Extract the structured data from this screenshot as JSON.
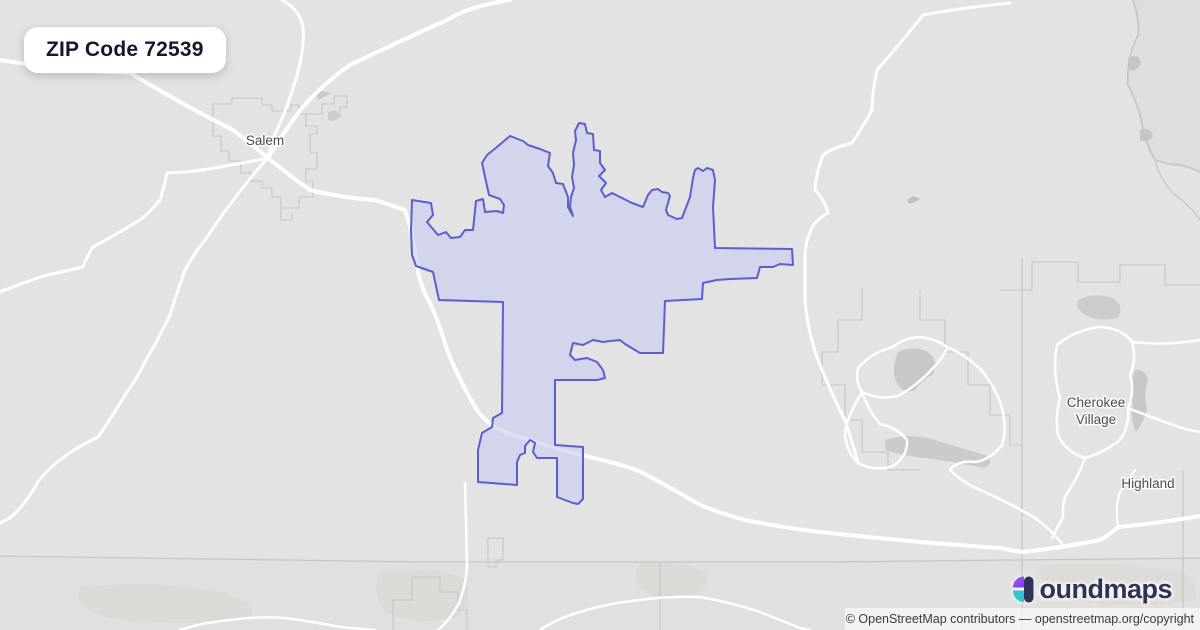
{
  "title_card": {
    "label": "ZIP Code 72539"
  },
  "branding": {
    "name": "boundmaps",
    "display_suffix": "oundmaps",
    "icon": "boundmaps-b-icon",
    "colors": {
      "navy": "#2e3357",
      "purple_top": "#a855f7",
      "purple_bottom": "#7c3aed",
      "teal": "#2fc4cf"
    }
  },
  "attribution": {
    "text": "© OpenStreetMap contributors — openstreetmap.org/copyright"
  },
  "map": {
    "colors": {
      "bg": "#e3e3e3",
      "road": "#ffffff",
      "admin": "#c6c6c6",
      "river": "#c4c4c4",
      "patch": "#cfcfcf",
      "label": "#4d4d4d",
      "halo": "rgba(255,255,255,0.85)",
      "zip_stroke": "#5a5fd0",
      "zip_fill": "rgba(198,203,242,0.6)"
    },
    "zip_boundary": {
      "name": "zip-72539-boundary",
      "points": "412,200 431,203 433,215 427,222 438,235 446,232 451,238 460,237 465,230 473,230 476,201 483,199 485,212 497,211 503,213 504,205 500,199 489,195 482,163 487,155 497,147 510,136 523,141 528,145 540,149 550,153 548,166 553,173 556,183 563,184 568,197 568,207 573,216 570,207 571,197 574,188 572,177 574,165 573,153 576,140 575,131 579,123 585,124 587,133 593,134 594,150 600,151 600,163 605,170 599,176 606,183 601,190 605,197 612,193 622,198 632,203 643,207 648,195 652,190 658,189 662,192 668,193 670,196 666,210 668,215 677,219 682,218 690,197 693,178 695,170 698,168 703,171 707,168 713,170 715,180 713,207 715,248 792,249 793,265 780,264 773,267 760,267 757,278 730,279 717,280 703,283 702,299 665,301 663,353 640,353 625,344 620,340 610,341 603,342 593,340 583,345 573,343 570,355 575,360 587,358 597,362 603,370 605,378 597,380 555,380 555,445 583,447 583,499 578,504 573,503 565,500 557,497 557,458 537,458 533,452 535,443 530,440 525,446 525,453 520,455 517,462 517,485 478,482 478,450 482,433 492,427 493,418 502,413 503,302 439,300 433,272 416,266 412,255 411,230"
    },
    "labels": [
      {
        "lines": [
          "Salem"
        ],
        "x": 265,
        "y": 145,
        "size": 13.5
      },
      {
        "lines": [
          "Cherokee",
          "Village"
        ],
        "x": 1096,
        "y": 407,
        "size": 13.5
      },
      {
        "lines": [
          "Highland"
        ],
        "x": 1148,
        "y": 488,
        "size": 13.5
      }
    ],
    "patches": [
      {
        "d": "M0,557 L1200,559 L1200,630 L0,630 Z",
        "fill": "#dcdcd8",
        "o": 0.45
      },
      {
        "d": "M1133,0 L1200,0 L1200,172 L1180,165 L1150,158 L1140,120 L1128,80 L1138,30 Z",
        "fill": "#dadada",
        "o": 0.5
      },
      {
        "d": "M315,90 L332,93 L318,100 Z",
        "fill": "#c9c9c9",
        "o": 1
      },
      {
        "d": "M328,112 Q338,108 340,116 Q336,123 328,120 Z",
        "fill": "#cccccc",
        "o": 1
      },
      {
        "d": "M907,200 L914,196 L920,199 L915,202 L909,204 Z",
        "fill": "#bfbfbf",
        "o": 1
      },
      {
        "d": "M898,352 Q915,345 928,352 Q940,362 932,375 Q922,380 915,390 Q905,395 898,385 Q890,372 898,352 Z",
        "fill": "#c8c8c8",
        "o": 1
      },
      {
        "d": "M885,440 Q910,432 935,440 Q960,448 985,455 Q995,462 985,468 Q955,462 925,458 Q900,455 885,450 Z",
        "fill": "#cbcbcb",
        "o": 1
      },
      {
        "d": "M1135,370 Q1145,368 1148,380 Q1143,395 1147,410 Q1142,425 1136,432 Q1130,420 1133,405 Q1128,388 1135,370 Z",
        "fill": "#c8c8c8",
        "o": 1
      },
      {
        "d": "M1078,300 Q1095,292 1112,298 Q1125,305 1118,318 Q1100,322 1085,315 Q1075,308 1078,300 Z",
        "fill": "#cccccc",
        "o": 1
      },
      {
        "d": "M1128,58 Q1137,52 1141,62 Q1138,72 1129,70 Z",
        "fill": "#c5c5c5",
        "o": 1
      },
      {
        "d": "M1140,130 Q1150,126 1153,136 Q1148,144 1140,140 Z",
        "fill": "#c5c5c5",
        "o": 1
      },
      {
        "d": "M80,588 Q150,578 220,592 Q260,602 250,618 Q180,628 110,618 Q70,608 80,588 Z",
        "fill": "#d6d6d2",
        "o": 0.6
      },
      {
        "d": "M380,572 Q430,566 465,578 Q475,600 455,618 Q410,626 385,612 Q370,590 380,572 Z",
        "fill": "#d6d6d2",
        "o": 0.6
      },
      {
        "d": "M640,563 Q680,560 706,572 Q712,588 690,598 Q655,600 640,588 Q632,572 640,563 Z",
        "fill": "#d6d6d2",
        "o": 0.55
      },
      {
        "d": "M1040,565 Q1110,560 1180,572 Q1200,580 1195,600 Q1130,610 1070,600 Q1035,585 1040,565 Z",
        "fill": "#d6d6d2",
        "o": 0.5
      }
    ],
    "admin_lines": [
      {
        "d": "M0,556 L420,562 L830,562 L1200,558",
        "w": 1.2
      },
      {
        "d": "M1022,258 L1022,630",
        "w": 1.2
      },
      {
        "d": "M1183,470 L1183,630",
        "w": 1.2
      },
      {
        "d": "M1000,290 L1032,290 L1032,262 L1078,262 L1078,282 L1120,282 L1120,265 L1165,265 L1165,285 L1200,285",
        "w": 1.1
      },
      {
        "d": "M862,288 L862,320 L838,320 L838,352 L822,352 L822,385 L845,385 L845,420 L862,420 L862,452 L888,452 L888,470 L920,470",
        "w": 1.1
      },
      {
        "d": "M920,290 L920,320 L945,320 L945,352 L968,352 L968,385 L990,385 L990,415 L1010,415 L1010,445 L1022,445",
        "w": 1.1
      },
      {
        "d": "M393,630 L393,600 L412,600 L412,577 L440,577 L440,592 L458,592 L458,610 L467,610 L467,630",
        "w": 1.1
      },
      {
        "d": "M660,562 L660,630",
        "w": 1.1
      },
      {
        "d": "M488,538 L503,538 L503,560 L496,560 L496,567 L488,567 Z",
        "w": 1.1
      },
      {
        "d": "M213,104 L232,104 L232,98 L262,98 L262,105 L272,105 L272,111 L291,111 L291,105 L299,105 L299,114 L306,114 L306,126 L317,126 L317,134 L310,134 L310,153 L317,153 L317,169 L306,169 L306,181 L313,181 L313,197 L299,197 L299,208 L281,208 L281,197 L272,197 L272,188 L262,188 L262,181 L251,181 L251,173 L241,173 L241,161 L229,161 L229,151 L221,151 L221,136 L213,136 Z",
        "w": 1.1
      },
      {
        "d": "M306,114 L322,114 L322,104 L334,104 L334,96 L347,96 L347,107 L340,107 L340,118",
        "w": 1.1
      },
      {
        "d": "M281,208 L281,220 L292,220 L292,213",
        "w": 1.1
      }
    ],
    "rivers": [
      {
        "d": "M1133,0 Q1140,20 1138,35 Q1126,60 1128,85 Q1140,108 1143,130 Q1148,148 1155,160 Q1170,165 1180,165 Q1192,168 1200,172",
        "w": 1.6
      },
      {
        "d": "M1155,160 Q1160,180 1175,195 Q1190,205 1200,220",
        "w": 1.2
      }
    ],
    "roads": [
      {
        "d": "M0,60 Q60,70 130,73 Q187,107 233,130 Q255,147 268,158",
        "w": 4
      },
      {
        "d": "M282,0 Q300,10 303,27 Q305,50 295,82 Q285,115 272,140 L268,158",
        "w": 3
      },
      {
        "d": "M510,0 Q470,6 447,20 Q413,35 350,65 Q325,82 302,108 Q285,130 268,158",
        "w": 4
      },
      {
        "d": "M268,158 Q290,176 310,190 Q343,198 375,200 L405,210 Q415,240 418,272 Q422,290 430,303 Q440,325 447,350 Q460,382 477,410 Q487,424 500,430 Q520,438 545,445 Q580,455 610,462 Q630,467 643,473 Q675,490 700,505 Q725,515 745,520 Q790,529 830,533 Q900,541 1000,548 Q1015,551 1023,552 Q1060,548 1100,540 Q1112,533 1118,527 Q1160,523 1200,516",
        "w": 4
      },
      {
        "d": "M268,158 Q250,162 230,165 Q207,170 185,172 L167,173 Q164,188 160,200 Q150,212 140,220 Q115,235 93,247 Q86,258 83,267 Q60,272 40,277 Q20,284 0,292",
        "w": 3
      },
      {
        "d": "M268,158 Q255,172 245,185 Q225,210 205,240 Q193,255 185,270 Q177,292 170,315 Q158,340 145,362 Q136,380 125,395 Q112,417 98,437 Q75,448 60,460 Q45,472 38,482 Q25,505 10,518 L0,523",
        "w": 3
      },
      {
        "d": "M1010,3 Q960,8 923,15 Q905,38 877,70 Q872,92 872,110 Q862,128 852,143 Q832,148 823,155 Q816,172 815,190 Q825,200 828,213 Q812,222 810,233 Q805,243 805,258 L805,300 Q808,335 820,365 Q832,395 845,420 Q852,442 858,462",
        "w": 3
      },
      {
        "d": "M893,347 Q872,352 858,368 Q855,382 862,392 Q878,400 898,396 Q918,385 933,368 Q945,355 947,347 Q935,338 918,337 Q902,339 893,347 Z",
        "w": 2.5
      },
      {
        "d": "M862,392 Q848,415 845,432 Q846,452 858,463 Q875,472 893,466 Q908,456 907,440 Q898,428 880,424 Q868,410 862,392",
        "w": 2.5
      },
      {
        "d": "M947,347 Q968,356 983,372 Q995,388 1000,402 Q1008,425 1002,445 Q990,460 975,462 Q958,460 950,470 Q962,482 980,490 Q1008,502 1035,518 Q1052,530 1063,545",
        "w": 2.5
      },
      {
        "d": "M1057,345 Q1075,330 1100,327 Q1122,328 1132,342 Q1137,360 1130,375 Q1135,392 1128,408 Q1130,425 1120,440 Q1105,452 1085,458 Q1066,452 1058,435 Q1055,415 1060,398 Q1052,372 1057,345 Z",
        "w": 2.5
      },
      {
        "d": "M1085,458 Q1078,478 1066,495 Q1062,505 1063,517 Q1057,528 1052,538",
        "w": 2.5
      },
      {
        "d": "M1132,342 Q1160,345 1185,342 Q1195,341 1200,340",
        "w": 2.5
      },
      {
        "d": "M1128,408 Q1158,420 1185,429 L1200,432",
        "w": 2.5
      },
      {
        "d": "M1118,527 Q1115,505 1120,492 Q1128,480 1135,470",
        "w": 2
      },
      {
        "d": "M180,630 Q205,622 230,620 Q260,616 285,618 Q315,622 340,627 L375,630",
        "w": 2.5
      },
      {
        "d": "M540,630 Q558,618 580,612 Q610,603 640,600 Q670,596 700,597 Q730,602 760,612 Q780,620 800,628 L810,630",
        "w": 2.5
      },
      {
        "d": "M465,483 L466,520 467,567 Q465,590 458,605 Q450,620 438,630",
        "w": 2.5
      }
    ]
  }
}
